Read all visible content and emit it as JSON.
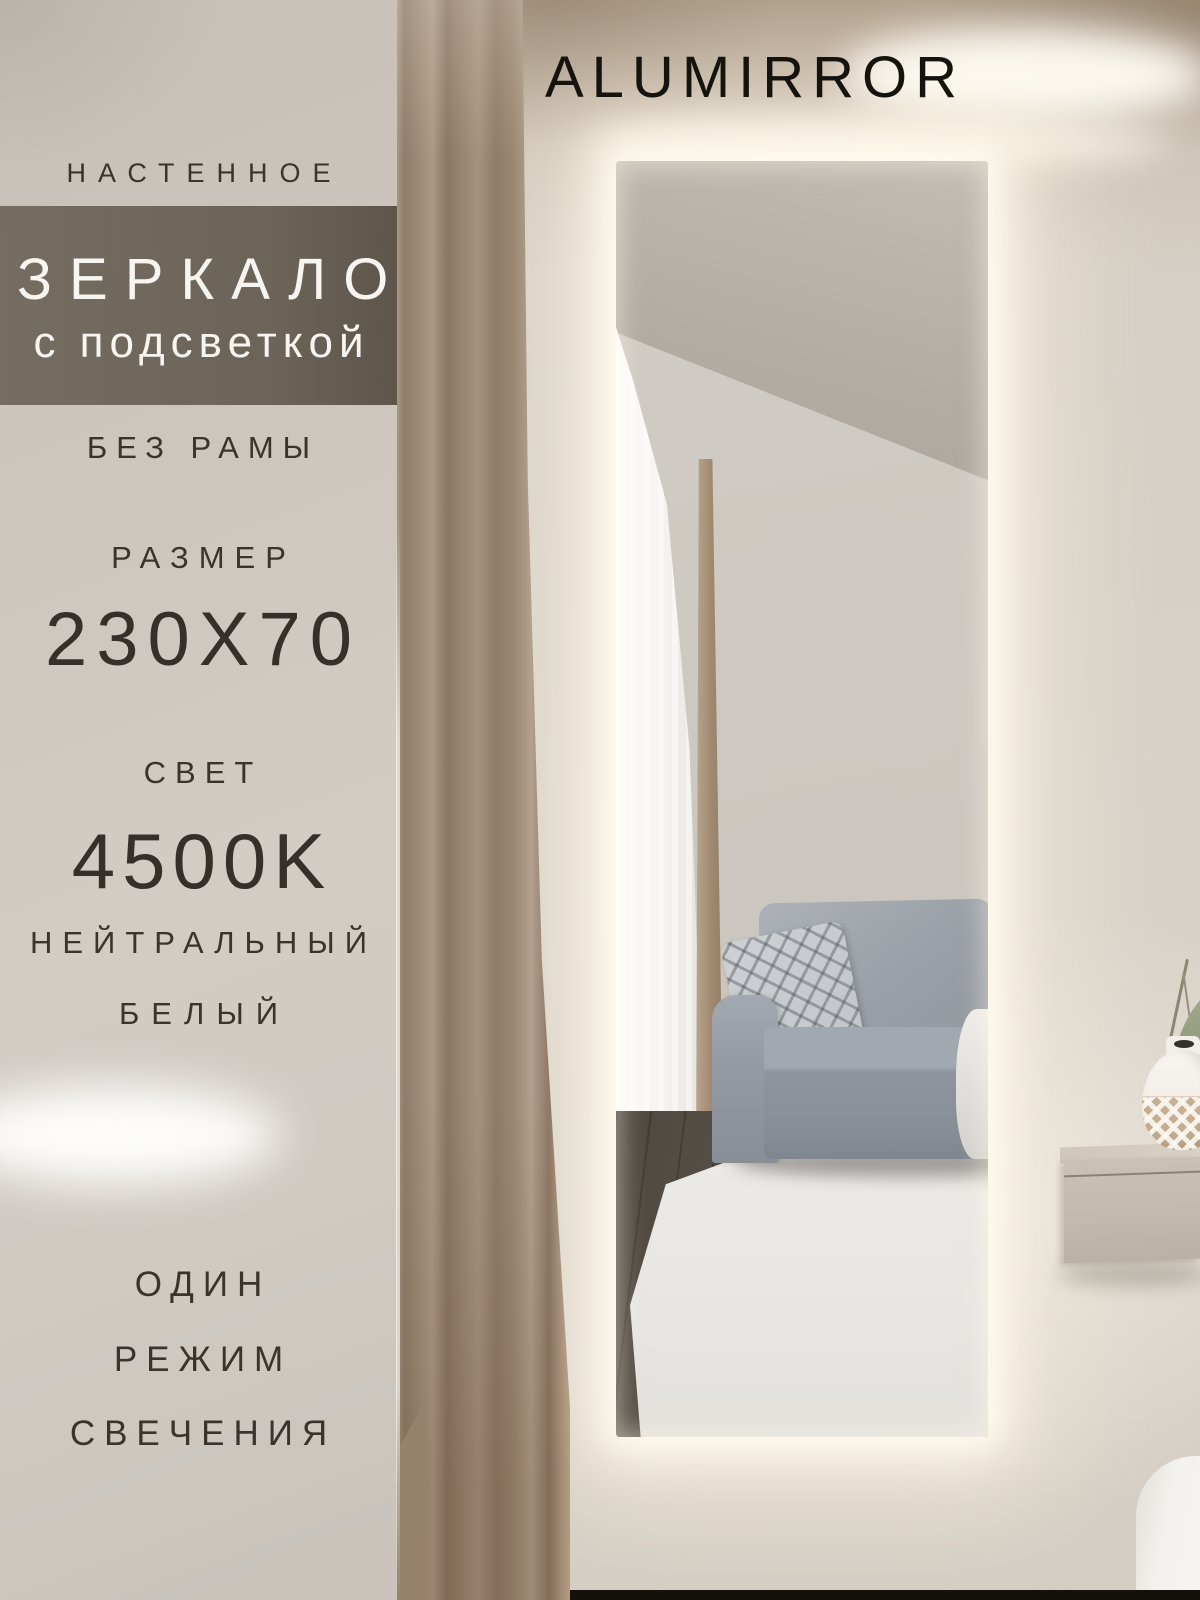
{
  "brand": {
    "name": "ALUMIRROR"
  },
  "panel": {
    "mount_type": "НАСТЕННОЕ",
    "product_title": "ЗЕРКАЛО",
    "product_subtitle": "с подсветкой",
    "frame_label": "БЕЗ РАМЫ",
    "size_label": "РАЗМЕР",
    "size_value": "230X70",
    "light_label": "СВЕТ",
    "light_temperature": "4500K",
    "light_tone_line1": "НЕЙТРАЛЬНЫЙ",
    "light_tone_line2": "БЕЛЫЙ",
    "mode_line1": "ОДИН",
    "mode_line2": "РЕЖИМ",
    "mode_line3": "СВЕЧЕНИЯ"
  },
  "colors": {
    "title_band_bg": "#6b6254",
    "panel_text": "#3a342c",
    "band_text": "#f7f5f1",
    "brand_text": "#15130e",
    "led_glow": "#fff7e4",
    "curtain": "#9b8873",
    "sofa": "#969ca3"
  }
}
